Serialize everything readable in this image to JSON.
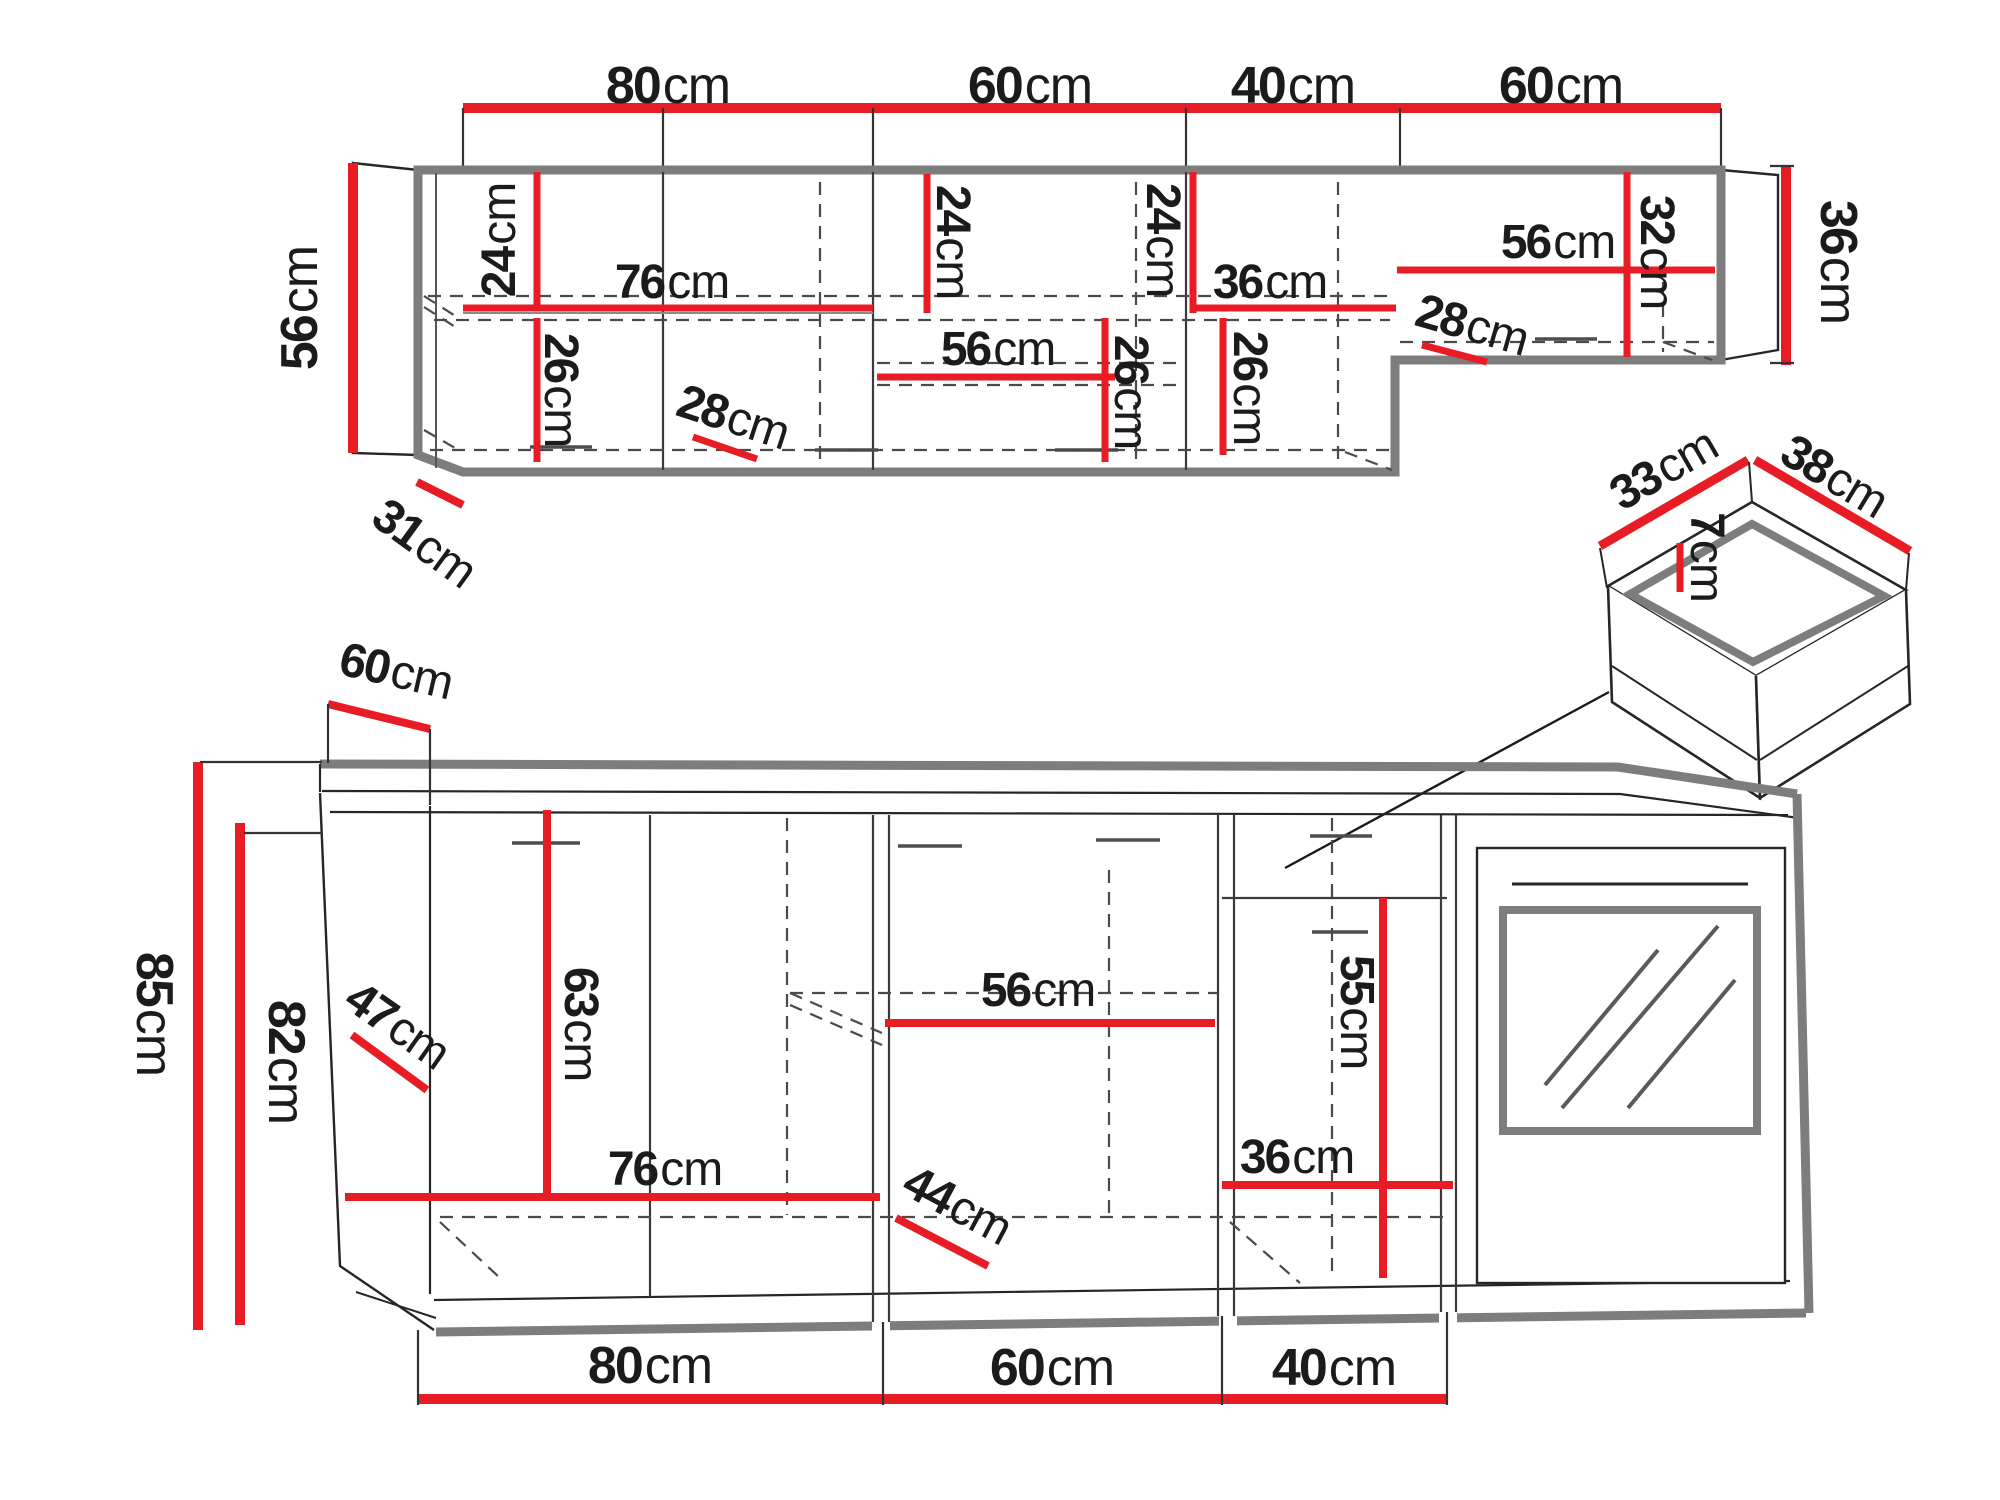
{
  "diagram": {
    "type": "kitchen-furniture-dimension-drawing",
    "unit": "cm"
  },
  "colors": {
    "dimension_red": "#e81c24",
    "outline_gray": "#7d7d7d",
    "line_black": "#262626"
  },
  "dims": {
    "top_80": {
      "value": "80",
      "unit": "cm"
    },
    "top_60a": {
      "value": "60",
      "unit": "cm"
    },
    "top_40": {
      "value": "40",
      "unit": "cm"
    },
    "top_60b": {
      "value": "60",
      "unit": "cm"
    },
    "upper_left_56": {
      "value": "56",
      "unit": "cm"
    },
    "upper_24_a": {
      "value": "24",
      "unit": "cm"
    },
    "upper_76": {
      "value": "76",
      "unit": "cm"
    },
    "upper_26_a": {
      "value": "26",
      "unit": "cm"
    },
    "upper_28_a": {
      "value": "28",
      "unit": "cm"
    },
    "upper_24_b": {
      "value": "24",
      "unit": "cm"
    },
    "upper_56_mid": {
      "value": "56",
      "unit": "cm"
    },
    "upper_26_b": {
      "value": "26",
      "unit": "cm"
    },
    "upper_24_c": {
      "value": "24",
      "unit": "cm"
    },
    "upper_36_inner": {
      "value": "36",
      "unit": "cm"
    },
    "upper_26_c": {
      "value": "26",
      "unit": "cm"
    },
    "upper_28_b": {
      "value": "28",
      "unit": "cm"
    },
    "upper_56_right": {
      "value": "56",
      "unit": "cm"
    },
    "upper_32": {
      "value": "32",
      "unit": "cm"
    },
    "upper_right_36": {
      "value": "36",
      "unit": "cm"
    },
    "upper_31": {
      "value": "31",
      "unit": "cm"
    },
    "drawer_33": {
      "value": "33",
      "unit": "cm"
    },
    "drawer_38": {
      "value": "38",
      "unit": "cm"
    },
    "drawer_7": {
      "value": "7",
      "unit": "cm"
    },
    "lower_60_top": {
      "value": "60",
      "unit": "cm"
    },
    "lower_85": {
      "value": "85",
      "unit": "cm"
    },
    "lower_82": {
      "value": "82",
      "unit": "cm"
    },
    "lower_47": {
      "value": "47",
      "unit": "cm"
    },
    "lower_63": {
      "value": "63",
      "unit": "cm"
    },
    "lower_76": {
      "value": "76",
      "unit": "cm"
    },
    "lower_44": {
      "value": "44",
      "unit": "cm"
    },
    "lower_56": {
      "value": "56",
      "unit": "cm"
    },
    "lower_55": {
      "value": "55",
      "unit": "cm"
    },
    "lower_36": {
      "value": "36",
      "unit": "cm"
    },
    "bottom_80": {
      "value": "80",
      "unit": "cm"
    },
    "bottom_60": {
      "value": "60",
      "unit": "cm"
    },
    "bottom_40": {
      "value": "40",
      "unit": "cm"
    }
  }
}
